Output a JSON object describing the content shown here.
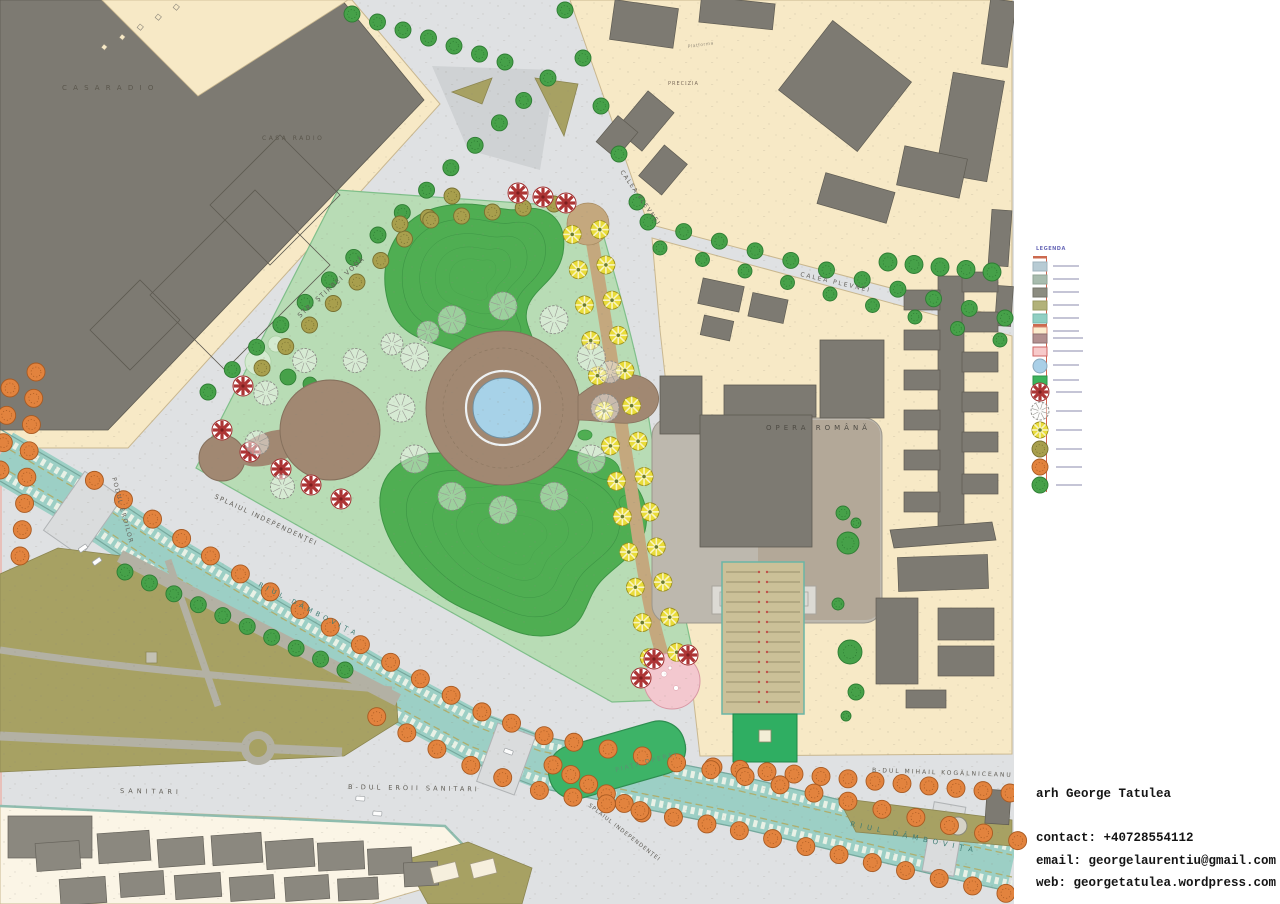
{
  "credits": {
    "name": "arh George Tatulea",
    "contact": "contact: +40728554112",
    "email": "email: georgelaurentiu@gmail.com",
    "web": "web: georgetatulea.wordpress.com"
  },
  "legend": {
    "title": "LEGENDA",
    "existing_swatches": [
      {
        "name": "roadway-swatch",
        "fill": "#b7cbd4",
        "border": "#9fb3bd"
      },
      {
        "name": "sidewalk-swatch",
        "fill": "#a8bcae",
        "border": "#90a496"
      },
      {
        "name": "existing-building-swatch",
        "fill": "#8c8c80",
        "border": "#74746a"
      },
      {
        "name": "existing-green-swatch",
        "fill": "#b2b279",
        "border": "#9a9a61"
      },
      {
        "name": "water-swatch",
        "fill": "#90cfc3",
        "border": "#78b7ab"
      },
      {
        "name": "city-block-swatch",
        "fill": "#fbeccd",
        "border": "#d98772"
      }
    ],
    "proposed_swatches": [
      {
        "name": "proposed-plaza-swatch",
        "fill": "#b29090",
        "border": "#8f6f6f"
      },
      {
        "name": "proposed-paving-swatch",
        "fill": "#f7caca",
        "border": "#cf6666"
      }
    ],
    "pond_symbol_color": "#a9cfe7",
    "proposed_green_color": "#3cb45c",
    "tree_symbols": [
      {
        "name": "red-white-pinwheel-tree"
      },
      {
        "name": "sketch-outline-tree"
      },
      {
        "name": "yellow-pinwheel-tree"
      },
      {
        "name": "olive-speckled-tree"
      },
      {
        "name": "orange-speckled-tree"
      },
      {
        "name": "green-speckled-tree"
      }
    ]
  },
  "map": {
    "colors": {
      "road": "#dfe1e3",
      "block_cream": "#f7e9c6",
      "block_ivory": "#fbf5e6",
      "building_gray": "#7d7a72",
      "park_light": "#b8dcb5",
      "mound_green": "#4fae52",
      "plaza_brown": "#a18872",
      "pond_blue": "#a7d2e8",
      "pink_plaza": "#f3c8cf",
      "canal_teal": "#9ccfc5",
      "olive_green": "#a7a163",
      "parking_tan": "#cbc098",
      "island_green": "#3db367",
      "tree_green": "#46a149",
      "tree_orange": "#e2833e",
      "tree_yellow": "#e9dc39",
      "tree_red": "#ad3535",
      "tree_olive": "#a89f4d"
    },
    "labels": [
      {
        "text": "C A S A   R A D I O",
        "x": 62,
        "y": 90,
        "rot": 0,
        "size": 7,
        "ls": 2,
        "color": "#5a564c"
      },
      {
        "text": "CASA RADIO",
        "x": 262,
        "y": 140,
        "rot": 0,
        "size": 6,
        "ls": 2.5,
        "color": "#5a564c"
      },
      {
        "text": "STR. ŞTIRBEI VODĂ",
        "x": 300,
        "y": 318,
        "rot": -42,
        "size": 6.5,
        "ls": 1.5,
        "color": "#63605a"
      },
      {
        "text": "CALEA PLEVNEI",
        "x": 620,
        "y": 172,
        "rot": 55,
        "size": 6,
        "ls": 1.5,
        "color": "#63605a"
      },
      {
        "text": "CALEA PLEVNEI",
        "x": 800,
        "y": 276,
        "rot": 13,
        "size": 6,
        "ls": 2,
        "color": "#63605a"
      },
      {
        "text": "SPLAIUL INDEPENDENŢEI",
        "x": 214,
        "y": 498,
        "rot": 25,
        "size": 6.5,
        "ls": 1.5,
        "color": "#63605a"
      },
      {
        "text": "SPLAIUL INDEPENDENŢEI",
        "x": 588,
        "y": 806,
        "rot": 38,
        "size": 5.5,
        "ls": 1,
        "color": "#63605a"
      },
      {
        "text": "PODUL EROILOR",
        "x": 112,
        "y": 478,
        "rot": 75,
        "size": 6,
        "ls": 1.5,
        "color": "#63605a"
      },
      {
        "text": "SANITARI",
        "x": 120,
        "y": 793,
        "rot": 1,
        "size": 6.5,
        "ls": 4,
        "color": "#5f5c55"
      },
      {
        "text": "B-DUL  EROII  SANITARI",
        "x": 348,
        "y": 789,
        "rot": 1,
        "size": 6.5,
        "ls": 3,
        "color": "#5f5c55"
      },
      {
        "text": "B-DUL  MIHAIL  KOGĂLNICEANU",
        "x": 872,
        "y": 772,
        "rot": 2,
        "size": 6,
        "ls": 2,
        "color": "#5f5c55"
      },
      {
        "text": "RIUL  DÂMBOVIŢA",
        "x": 850,
        "y": 826,
        "rot": 12,
        "size": 7,
        "ls": 5,
        "color": "#3f7d74"
      },
      {
        "text": "RIUL  DÂMBOVIŢA",
        "x": 258,
        "y": 586,
        "rot": 27,
        "size": 6.5,
        "ls": 4,
        "color": "#3f7d74"
      },
      {
        "text": "OPERA  ROMÂNĂ",
        "x": 766,
        "y": 430,
        "rot": 0,
        "size": 7,
        "ls": 4,
        "color": "#4e4b44"
      },
      {
        "text": "PIAŢA  OPEREI",
        "x": 616,
        "y": 772,
        "rot": -15,
        "size": 6,
        "ls": 2,
        "color": "#5f8f74"
      },
      {
        "text": "PRECIZIA",
        "x": 668,
        "y": 85,
        "rot": 0,
        "size": 5,
        "ls": 1,
        "color": "#7a6a5a"
      },
      {
        "text": "Platforma",
        "x": 688,
        "y": 48,
        "rot": -8,
        "size": 4.5,
        "ls": 0.5,
        "color": "#9a917f"
      }
    ]
  }
}
